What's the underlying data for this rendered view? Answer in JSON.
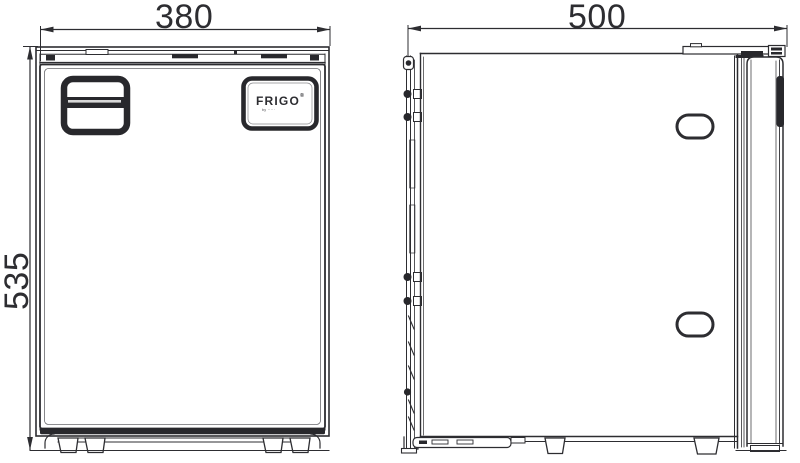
{
  "drawing": {
    "type": "technical-dimension-drawing",
    "colors": {
      "ink": "#2d2d31",
      "dark_fill": "#28282c",
      "background": "#ffffff",
      "slot_highlight": "#d8d8d8"
    }
  },
  "dimensions": {
    "front_width": "380",
    "front_height": "535",
    "side_depth": "500"
  },
  "brand_badge": {
    "name": "FRIGO",
    "mark": "®",
    "subtext": "by ·····"
  }
}
